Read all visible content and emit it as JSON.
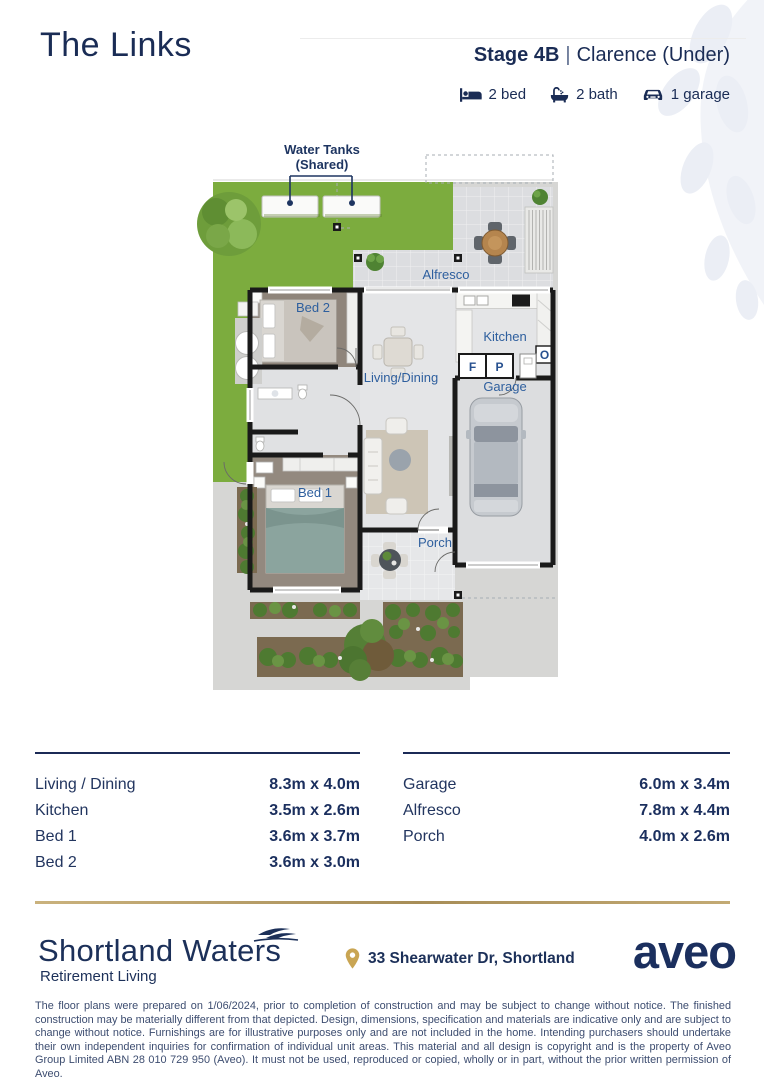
{
  "header": {
    "title": "The Links",
    "stage": "Stage 4B",
    "separator": "|",
    "variant": "Clarence (Under)",
    "features": [
      {
        "icon": "bed-icon",
        "label": "2 bed"
      },
      {
        "icon": "bath-icon",
        "label": "2 bath"
      },
      {
        "icon": "garage-icon",
        "label": "1 garage"
      }
    ]
  },
  "floorplan": {
    "annotation": {
      "line1": "Water Tanks",
      "line2": "(Shared)"
    },
    "rooms": {
      "alfresco": "Alfresco",
      "bed2": "Bed 2",
      "kitchen": "Kitchen",
      "living": "Living/Dining",
      "garage": "Garage",
      "bed1": "Bed 1",
      "porch": "Porch"
    },
    "markers": {
      "fridge": "F",
      "pantry": "P",
      "oven": "O"
    }
  },
  "dimensions": {
    "left": [
      {
        "room": "Living / Dining",
        "size": "8.3m x 4.0m"
      },
      {
        "room": "Kitchen",
        "size": "3.5m x 2.6m"
      },
      {
        "room": "Bed 1",
        "size": "3.6m x 3.7m"
      },
      {
        "room": "Bed 2",
        "size": "3.6m x 3.0m"
      }
    ],
    "right": [
      {
        "room": "Garage",
        "size": "6.0m x 3.4m"
      },
      {
        "room": "Alfresco",
        "size": "7.8m x 4.4m"
      },
      {
        "room": "Porch",
        "size": "4.0m x 2.6m"
      }
    ]
  },
  "footer": {
    "brand": "Shortland Waters",
    "brand_tagline": "Retirement Living",
    "address": "33 Shearwater Dr, Shortland",
    "logo": "aveo"
  },
  "disclaimer": "The floor plans were prepared on 1/06/2024, prior to completion of construction and may be subject to change without notice. The finished construction may be materially different from that depicted. Design, dimensions, specification and materials are indicative only and are subject to change without notice. Furnishings are for illustrative purposes only and are not included in the home. Intending purchasers should undertake their own independent inquiries for confirmation of individual unit areas. This material and all design is copyright and is the property of Aveo Group Limited ABN 28 010 729 950 (Aveo). It must not be used, reproduced or copied, wholly or in part, without the prior written permission of Aveo.",
  "colors": {
    "navy": "#1b2f5e",
    "label_blue": "#2e5f9e",
    "lawn_green": "#7cac3e",
    "gold": "#b49a64"
  }
}
